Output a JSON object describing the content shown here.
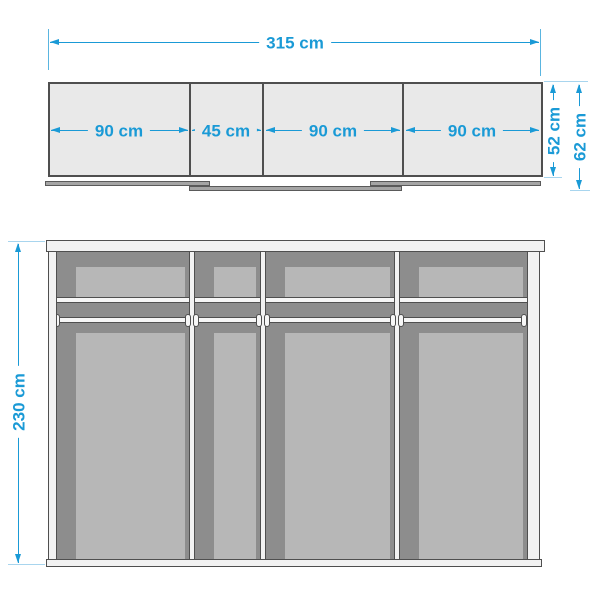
{
  "diagram": {
    "kind": "wardrobe dimension drawing",
    "colors": {
      "dimension_blue": "#1a9ad6",
      "extension_pale_blue": "#a8d5ee",
      "top_view_fill": "#e9e9e9",
      "outline_gray": "#4f4f4f",
      "interior_dark_gray": "#8d8d8d",
      "interior_light_gray": "#b7b7b7",
      "panel_white": "#f2f2f2",
      "track_gray": "#a5a5a5"
    },
    "top_view": {
      "total_width_label": "315 cm",
      "section_labels": [
        "90 cm",
        "45 cm",
        "90 cm",
        "90 cm"
      ],
      "inner_depth_label": "52 cm",
      "outer_depth_label": "62 cm"
    },
    "front_view": {
      "height_label": "230 cm"
    }
  }
}
